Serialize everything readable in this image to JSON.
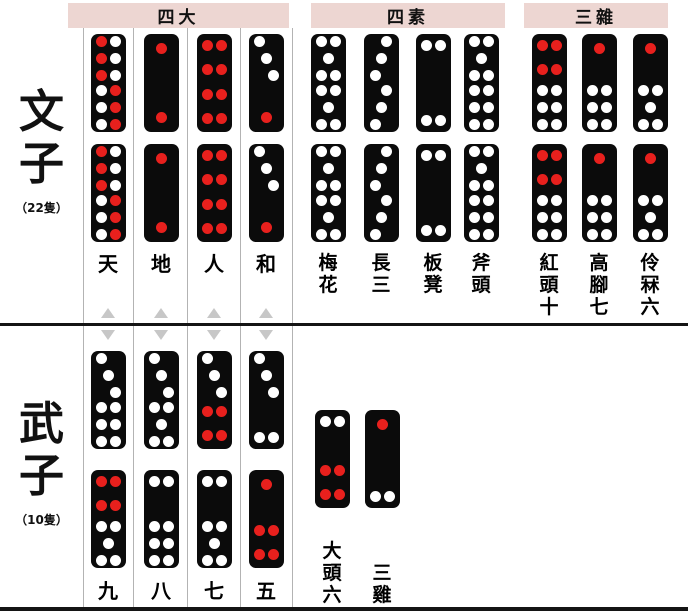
{
  "colors": {
    "header_bg": "#edd6d2",
    "tile_bg": "#0b0b0b",
    "pip_white": "#ffffff",
    "pip_red": "#e8201d",
    "line_gray": "#b3b3b3",
    "divider_black": "#141414",
    "arrow_gray": "#c7c7c7"
  },
  "civil": {
    "side_label": "文子",
    "side_count": "（22隻）",
    "groups": [
      {
        "header": "四大",
        "columns": [
          {
            "label": "天",
            "tile": {
              "top": {
                "n": 6,
                "color": "red-white"
              },
              "bottom": {
                "n": 6,
                "color": "white-red"
              }
            }
          },
          {
            "label": "地",
            "tile": {
              "top": {
                "n": 1,
                "color": "red"
              },
              "bottom": {
                "n": 1,
                "color": "red"
              }
            }
          },
          {
            "label": "人",
            "tile": {
              "top": {
                "n": 4,
                "color": "red"
              },
              "bottom": {
                "n": 4,
                "color": "red"
              }
            }
          },
          {
            "label": "和",
            "tile": {
              "top": {
                "n": 3,
                "color": "white",
                "diag": "tlbr"
              },
              "bottom": {
                "n": 1,
                "color": "red"
              }
            }
          }
        ]
      },
      {
        "header": "四素",
        "columns": [
          {
            "label": "梅花",
            "tile": {
              "top": {
                "n": 5,
                "color": "white"
              },
              "bottom": {
                "n": 5,
                "color": "white"
              }
            }
          },
          {
            "label": "長三",
            "tile": {
              "top": {
                "n": 3,
                "color": "white",
                "diag": "trbl"
              },
              "bottom": {
                "n": 3,
                "color": "white",
                "diag": "trbl"
              }
            }
          },
          {
            "label": "板凳",
            "tile": {
              "top": {
                "n": 2,
                "color": "white"
              },
              "bottom": {
                "n": 2,
                "color": "white"
              }
            }
          },
          {
            "label": "斧頭",
            "tile": {
              "top": {
                "n": 5,
                "color": "white"
              },
              "bottom": {
                "n": 6,
                "color": "white"
              }
            }
          }
        ]
      },
      {
        "header": "三雜",
        "columns": [
          {
            "label": "紅頭十",
            "tile": {
              "top": {
                "n": 4,
                "color": "red"
              },
              "bottom": {
                "n": 6,
                "color": "white"
              }
            }
          },
          {
            "label": "高腳七",
            "tile": {
              "top": {
                "n": 1,
                "color": "red"
              },
              "bottom": {
                "n": 6,
                "color": "white"
              }
            }
          },
          {
            "label": "伶冧六",
            "tile": {
              "top": {
                "n": 1,
                "color": "red"
              },
              "bottom": {
                "n": 5,
                "color": "white"
              }
            }
          }
        ]
      }
    ]
  },
  "military": {
    "side_label": "武子",
    "side_count": "（10隻）",
    "pair_columns": [
      {
        "label": "九",
        "tiles": [
          {
            "top": {
              "n": 3,
              "color": "white",
              "diag": "tlbr"
            },
            "bottom": {
              "n": 6,
              "color": "white"
            }
          },
          {
            "top": {
              "n": 4,
              "color": "red"
            },
            "bottom": {
              "n": 5,
              "color": "white"
            }
          }
        ]
      },
      {
        "label": "八",
        "tiles": [
          {
            "top": {
              "n": 3,
              "color": "white",
              "diag": "tlbr"
            },
            "bottom": {
              "n": 5,
              "color": "white"
            }
          },
          {
            "top": {
              "n": 2,
              "color": "white"
            },
            "bottom": {
              "n": 6,
              "color": "white"
            }
          }
        ]
      },
      {
        "label": "七",
        "tiles": [
          {
            "top": {
              "n": 3,
              "color": "white",
              "diag": "tlbr"
            },
            "bottom": {
              "n": 4,
              "color": "red"
            }
          },
          {
            "top": {
              "n": 2,
              "color": "white"
            },
            "bottom": {
              "n": 5,
              "color": "white"
            }
          }
        ]
      },
      {
        "label": "五",
        "tiles": [
          {
            "top": {
              "n": 3,
              "color": "white",
              "diag": "tlbr"
            },
            "bottom": {
              "n": 2,
              "color": "white"
            }
          },
          {
            "top": {
              "n": 1,
              "color": "red"
            },
            "bottom": {
              "n": 4,
              "color": "red"
            }
          }
        ]
      }
    ],
    "single_columns": [
      {
        "label": "大頭六",
        "tile": {
          "top": {
            "n": 2,
            "color": "white"
          },
          "bottom": {
            "n": 4,
            "color": "red"
          }
        }
      },
      {
        "label": "三雞",
        "tile": {
          "top": {
            "n": 1,
            "color": "red"
          },
          "bottom": {
            "n": 2,
            "color": "white"
          }
        }
      }
    ]
  }
}
